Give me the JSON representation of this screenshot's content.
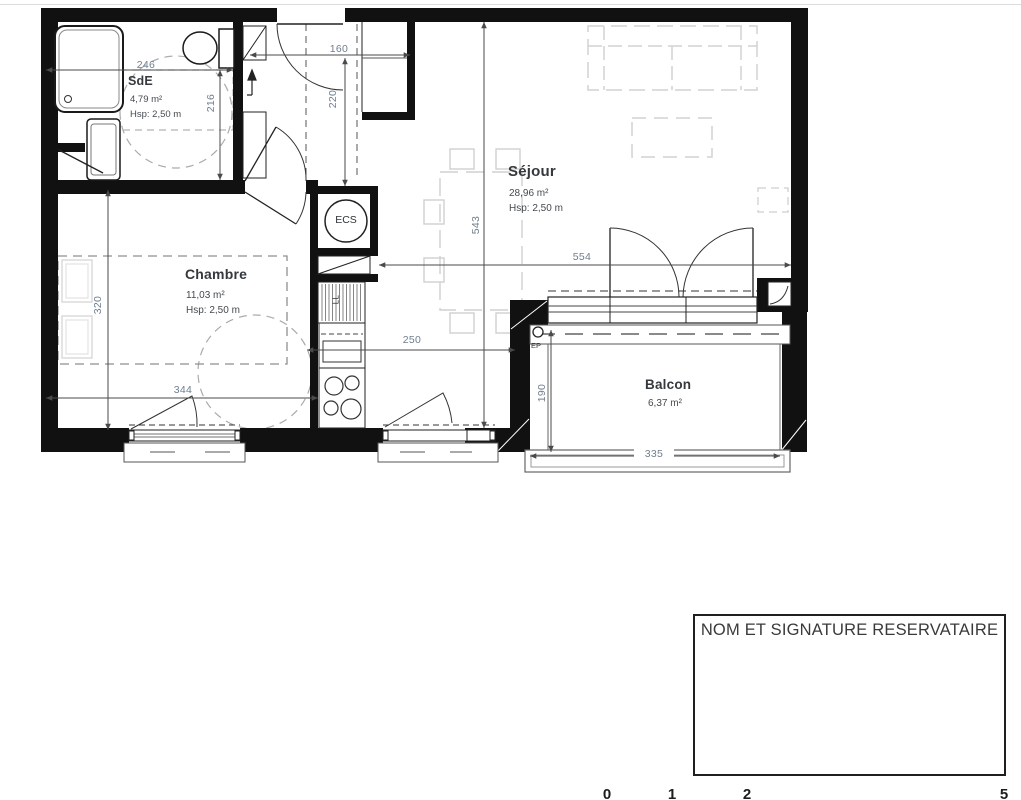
{
  "plan": {
    "rooms": {
      "sde": {
        "name": "SdE",
        "area": "4,79 m²",
        "height": "Hsp: 2,50 m"
      },
      "chambre": {
        "name": "Chambre",
        "area": "11,03 m²",
        "height": "Hsp: 2,50 m"
      },
      "sejour": {
        "name": "Séjour",
        "area": "28,96 m²",
        "height": "Hsp: 2,50 m"
      },
      "balcon": {
        "name": "Balcon",
        "area": "6,37 m²"
      }
    },
    "equipment": {
      "water_heater": "ECS",
      "washing_machine": "LL",
      "rain_pipe": "EP"
    },
    "dimensions": {
      "sde_width": "246",
      "sde_depth": "216",
      "hall_width": "160",
      "hall_depth": "220",
      "sejour_depth": "543",
      "sejour_width": "554",
      "chambre_depth": "320",
      "chambre_width": "344",
      "kitchen_width": "250",
      "balcon_depth": "190",
      "balcon_width": "335"
    },
    "colors": {
      "wall": "#111111",
      "dimension_text": "#6f7e8e",
      "room_label": "#35393d",
      "furniture": "#d2d2d2"
    }
  },
  "signature_box": {
    "title": "NOM ET SIGNATURE RESERVATAIRE"
  },
  "scale_bar": {
    "labels": [
      "0",
      "1",
      "2",
      "5"
    ]
  }
}
